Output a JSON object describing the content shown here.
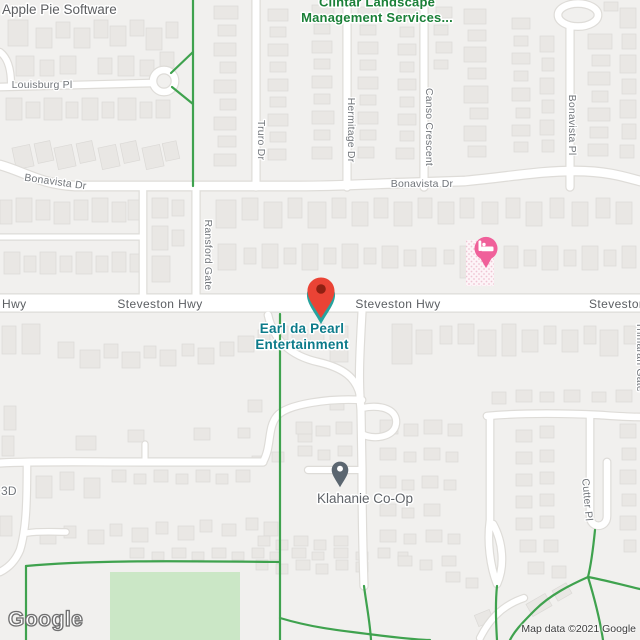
{
  "map": {
    "watermark": "Google",
    "attribution": "Map data ©2021 Google"
  },
  "street_labels": {
    "louisburg": "Louisburg Pl",
    "bonavista_dr": "Bonavista Dr",
    "truro": "Truro Dr",
    "hermitage": "Hermitage Dr",
    "canso": "Canso Crescent",
    "bonavista_pl": "Bonavista Pl",
    "ransford": "Ransford Gate",
    "steveston": "Steveston Hwy",
    "steveston_left_partial": "Hwy",
    "trimaran": "Trimaran Gate",
    "cutter": "Cutter Pl",
    "left_edge_partial": "3D"
  },
  "pois": {
    "apple_pie": {
      "name": "Apple Pie Software",
      "color": "#5c5e61"
    },
    "clintar": {
      "line1": "Clintar Landscape",
      "line2": "Management Services...",
      "color": "#1b8038"
    },
    "earl": {
      "line1": "Earl da Pearl",
      "line2": "Entertainment",
      "color": "#0c7b8a"
    },
    "klahanie": {
      "name": "Klahanie Co-Op",
      "color": "#5f6368"
    }
  },
  "markers": {
    "earl_pin": {
      "label": "Earl da Pearl Entertainment",
      "color": "#ea4335",
      "dot_color": "#8f2012",
      "shadow_color": "#27a39e"
    },
    "hotel_pin": {
      "label": "hotel",
      "color": "#f0609a"
    },
    "klahanie_pin": {
      "label": "Klahanie Co-Op",
      "color": "#5b6670"
    }
  },
  "colors": {
    "land": "#f1f0ee",
    "building": "#e9e7e4",
    "building_stroke": "#dbd9d6",
    "road": "#ffffff",
    "road_casing": "#dedcd8",
    "trail_green": "#3fa24e",
    "park_green": "#cbe7c6"
  }
}
